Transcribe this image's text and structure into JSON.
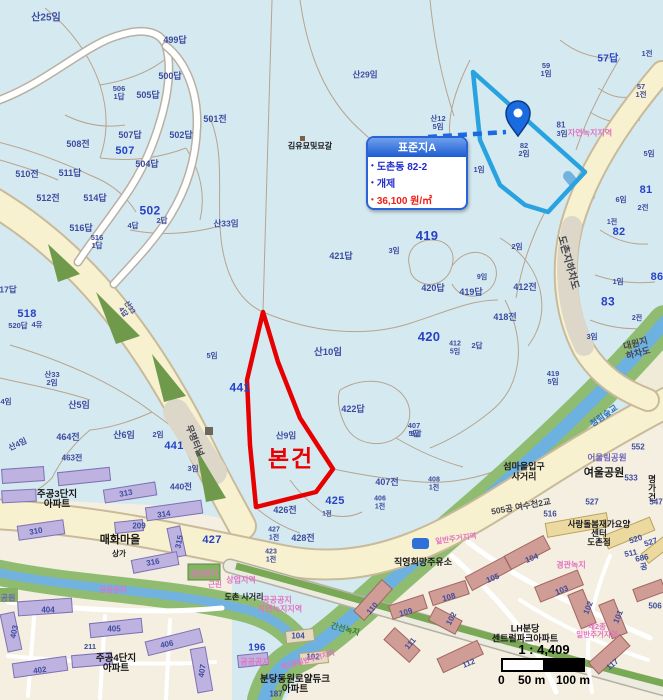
{
  "info_box": {
    "title": "표준지A",
    "rows": [
      {
        "text": "도촌동 82-2",
        "color": "blue"
      },
      {
        "text": "개제",
        "color": "blue"
      },
      {
        "text": "36,100 원/㎡",
        "color": "red"
      }
    ],
    "accent_color": "#2a62d8",
    "value_color": "#f11e12"
  },
  "scale_bar": {
    "ratio": "1 : 4,409",
    "start": "0",
    "mid": "50 m",
    "end": "100 m"
  },
  "map": {
    "overlays": {
      "subject_parcel": {
        "label": "본건",
        "color": "#e60000",
        "points": [
          [
            263,
            312
          ],
          [
            278,
            362
          ],
          [
            300,
            418
          ],
          [
            333,
            469
          ],
          [
            316,
            492
          ],
          [
            256,
            507
          ],
          [
            250,
            445
          ],
          [
            247,
            380
          ]
        ]
      },
      "standard_parcel": {
        "label": "표준지A",
        "color": "#29a3e0",
        "points": [
          [
            473,
            72
          ],
          [
            480,
            140
          ],
          [
            500,
            185
          ],
          [
            525,
            205
          ],
          [
            548,
            212
          ],
          [
            585,
            172
          ]
        ]
      },
      "leader_line": {
        "from": [
          428,
          137
        ],
        "to": [
          506,
          132
        ],
        "color": "#1a6be0"
      },
      "pin": {
        "x": 518,
        "y": 136,
        "color": "#1a6be0"
      }
    },
    "labels": [
      {
        "t": "산25임",
        "x": 46,
        "y": 19,
        "s": 10
      },
      {
        "t": "499답",
        "x": 175,
        "y": 41
      },
      {
        "t": "500답",
        "x": 170,
        "y": 77
      },
      {
        "t": "505답",
        "x": 148,
        "y": 96
      },
      {
        "t": "506\n1답",
        "x": 119,
        "y": 93,
        "s": 7.5
      },
      {
        "t": "501전",
        "x": 215,
        "y": 120
      },
      {
        "t": "508전",
        "x": 78,
        "y": 145
      },
      {
        "t": "507답",
        "x": 130,
        "y": 136
      },
      {
        "t": "507",
        "x": 125,
        "y": 152,
        "c": "n",
        "s": 11
      },
      {
        "t": "504답",
        "x": 147,
        "y": 165
      },
      {
        "t": "502답",
        "x": 181,
        "y": 136
      },
      {
        "t": "산29임",
        "x": 365,
        "y": 75,
        "s": 8.5
      },
      {
        "t": "김유묘및묘갈",
        "x": 310,
        "y": 147,
        "c": "k",
        "s": 8
      },
      {
        "t": "산12\n5임",
        "x": 438,
        "y": 123,
        "s": 7.5
      },
      {
        "t": "57답",
        "x": 608,
        "y": 60,
        "c": "n",
        "s": 10
      },
      {
        "t": "59\n1임",
        "x": 546,
        "y": 70,
        "s": 7.5
      },
      {
        "t": "1전",
        "x": 647,
        "y": 54,
        "s": 7.5
      },
      {
        "t": "57\n1전",
        "x": 641,
        "y": 91,
        "s": 7.5
      },
      {
        "t": "82\n2임",
        "x": 524,
        "y": 150,
        "s": 7.5
      },
      {
        "t": "1임",
        "x": 479,
        "y": 170,
        "s": 7.5
      },
      {
        "t": "81",
        "x": 561,
        "y": 126,
        "s": 8
      },
      {
        "t": "3임",
        "x": 562,
        "y": 134,
        "s": 7.5
      },
      {
        "t": "자연녹지지역",
        "x": 590,
        "y": 134,
        "c": "z",
        "s": 8
      },
      {
        "t": "5임",
        "x": 649,
        "y": 154,
        "s": 7.5
      },
      {
        "t": "419",
        "x": 427,
        "y": 236,
        "c": "n",
        "s": 13
      },
      {
        "t": "3임",
        "x": 394,
        "y": 251,
        "s": 7.5
      },
      {
        "t": "421답",
        "x": 341,
        "y": 257
      },
      {
        "t": "2임",
        "x": 517,
        "y": 247,
        "s": 7.5
      },
      {
        "t": "420답",
        "x": 433,
        "y": 289
      },
      {
        "t": "419답",
        "x": 471,
        "y": 293
      },
      {
        "t": "9임",
        "x": 482,
        "y": 278,
        "s": 7
      },
      {
        "t": "412전",
        "x": 525,
        "y": 288
      },
      {
        "t": "418전",
        "x": 505,
        "y": 318
      },
      {
        "t": "420",
        "x": 429,
        "y": 337,
        "c": "n",
        "s": 13
      },
      {
        "t": "412\n5임",
        "x": 455,
        "y": 348,
        "s": 7
      },
      {
        "t": "2답",
        "x": 477,
        "y": 346,
        "s": 7.5
      },
      {
        "t": "도촌지하차도",
        "x": 567,
        "y": 263,
        "c": "r",
        "s": 10,
        "r": 75
      },
      {
        "t": "81",
        "x": 646,
        "y": 191,
        "c": "n",
        "s": 11
      },
      {
        "t": "6임",
        "x": 621,
        "y": 200,
        "s": 7.5
      },
      {
        "t": "2전",
        "x": 643,
        "y": 208,
        "s": 7.5
      },
      {
        "t": "1전",
        "x": 612,
        "y": 223,
        "s": 7
      },
      {
        "t": "82",
        "x": 619,
        "y": 233,
        "c": "n",
        "s": 11
      },
      {
        "t": "86",
        "x": 657,
        "y": 278,
        "c": "n",
        "s": 11
      },
      {
        "t": "1임",
        "x": 618,
        "y": 282,
        "s": 7.5
      },
      {
        "t": "83",
        "x": 608,
        "y": 302,
        "c": "n",
        "s": 12
      },
      {
        "t": "2전",
        "x": 637,
        "y": 319,
        "s": 7
      },
      {
        "t": "3임",
        "x": 592,
        "y": 337,
        "s": 7.5
      },
      {
        "t": "대원지하차도",
        "x": 637,
        "y": 349,
        "c": "r",
        "s": 9,
        "r": -15
      },
      {
        "t": "419\n5임",
        "x": 553,
        "y": 378,
        "s": 7.5
      },
      {
        "t": "산33임",
        "x": 226,
        "y": 224,
        "s": 8.5
      },
      {
        "t": "510전",
        "x": 27,
        "y": 175
      },
      {
        "t": "511답",
        "x": 70,
        "y": 174
      },
      {
        "t": "512전",
        "x": 48,
        "y": 199
      },
      {
        "t": "514답",
        "x": 95,
        "y": 199
      },
      {
        "t": "516답",
        "x": 81,
        "y": 229
      },
      {
        "t": "516\n1답",
        "x": 97,
        "y": 242,
        "s": 7.5
      },
      {
        "t": "502",
        "x": 150,
        "y": 211,
        "c": "n",
        "s": 12
      },
      {
        "t": "4답",
        "x": 133,
        "y": 226,
        "s": 7.5
      },
      {
        "t": "2답",
        "x": 162,
        "y": 221,
        "s": 7.5
      },
      {
        "t": "17답",
        "x": 8,
        "y": 290,
        "s": 8.5
      },
      {
        "t": "518",
        "x": 27,
        "y": 315,
        "c": "n",
        "s": 11
      },
      {
        "t": "520답",
        "x": 18,
        "y": 326,
        "s": 7.5
      },
      {
        "t": "4유",
        "x": 37,
        "y": 325,
        "s": 7.5
      },
      {
        "t": "산33\n4답",
        "x": 126,
        "y": 310,
        "s": 7,
        "r": 55
      },
      {
        "t": "441",
        "x": 240,
        "y": 388,
        "c": "n",
        "s": 12
      },
      {
        "t": "산10임",
        "x": 328,
        "y": 353,
        "s": 9.5
      },
      {
        "t": "산9임",
        "x": 286,
        "y": 436,
        "s": 8.5
      },
      {
        "t": "본건",
        "x": 291,
        "y": 459,
        "c": "red",
        "s": 23
      },
      {
        "t": "422답",
        "x": 353,
        "y": 410
      },
      {
        "t": "407\n5답",
        "x": 414,
        "y": 430,
        "s": 7.5
      },
      {
        "t": "산33\n2임",
        "x": 52,
        "y": 379,
        "s": 7.5
      },
      {
        "t": "4임",
        "x": 6,
        "y": 402,
        "s": 7.5
      },
      {
        "t": "산5임",
        "x": 79,
        "y": 406,
        "s": 9
      },
      {
        "t": "464전",
        "x": 68,
        "y": 438
      },
      {
        "t": "산4임",
        "x": 18,
        "y": 445,
        "s": 8,
        "r": -25
      },
      {
        "t": "463전",
        "x": 72,
        "y": 459,
        "s": 8
      },
      {
        "t": "산6임",
        "x": 124,
        "y": 436,
        "s": 9
      },
      {
        "t": "2임",
        "x": 158,
        "y": 435,
        "s": 7.5
      },
      {
        "t": "441",
        "x": 174,
        "y": 447,
        "c": "n",
        "s": 11
      },
      {
        "t": "3임",
        "x": 193,
        "y": 469,
        "s": 7.5
      },
      {
        "t": "440전",
        "x": 181,
        "y": 487,
        "s": 8.5
      },
      {
        "t": "5임",
        "x": 212,
        "y": 356,
        "s": 7.5
      },
      {
        "t": "무명터널",
        "x": 194,
        "y": 441,
        "c": "r",
        "s": 9,
        "r": 68
      },
      {
        "t": "407전",
        "x": 387,
        "y": 483
      },
      {
        "t": "406\n1전",
        "x": 380,
        "y": 503,
        "s": 7
      },
      {
        "t": "408\n1전",
        "x": 434,
        "y": 484,
        "s": 7
      },
      {
        "t": "425",
        "x": 335,
        "y": 502,
        "c": "n",
        "s": 11
      },
      {
        "t": "426전",
        "x": 285,
        "y": 511
      },
      {
        "t": "427\n1전",
        "x": 274,
        "y": 534,
        "s": 7
      },
      {
        "t": "428전",
        "x": 303,
        "y": 539
      },
      {
        "t": "1전",
        "x": 327,
        "y": 514,
        "s": 6.5
      },
      {
        "t": "427",
        "x": 212,
        "y": 541,
        "c": "n",
        "s": 11
      },
      {
        "t": "423\n1전",
        "x": 271,
        "y": 556,
        "s": 7
      },
      {
        "t": "공공공지",
        "x": 277,
        "y": 601,
        "c": "z",
        "s": 8
      },
      {
        "t": "자연녹지지역",
        "x": 280,
        "y": 610,
        "c": "z",
        "s": 8
      },
      {
        "t": "도촌 사거리",
        "x": 244,
        "y": 598,
        "c": "k",
        "s": 8
      },
      {
        "t": "상업지역",
        "x": 241,
        "y": 581,
        "c": "z",
        "s": 8
      },
      {
        "t": "매화마을",
        "x": 120,
        "y": 541,
        "c": "k",
        "s": 11
      },
      {
        "t": "310",
        "x": 36,
        "y": 532,
        "s": 8,
        "r": -10
      },
      {
        "t": "315",
        "x": 180,
        "y": 542,
        "s": 8,
        "r": -78
      },
      {
        "t": "316",
        "x": 153,
        "y": 563,
        "s": 8,
        "r": -10
      },
      {
        "t": "209",
        "x": 139,
        "y": 527,
        "s": 8
      },
      {
        "t": "313",
        "x": 126,
        "y": 494,
        "s": 8,
        "r": -10
      },
      {
        "t": "314",
        "x": 164,
        "y": 515,
        "s": 8,
        "r": -8
      },
      {
        "t": "주공3단지\n아파트",
        "x": 57,
        "y": 500,
        "c": "k",
        "s": 9.5
      },
      {
        "t": "404",
        "x": 48,
        "y": 611,
        "s": 8
      },
      {
        "t": "405",
        "x": 114,
        "y": 630,
        "s": 8
      },
      {
        "t": "406",
        "x": 167,
        "y": 645,
        "s": 8,
        "r": -12
      },
      {
        "t": "402",
        "x": 40,
        "y": 671,
        "s": 8,
        "r": -8
      },
      {
        "t": "403",
        "x": 15,
        "y": 632,
        "s": 8,
        "r": -78
      },
      {
        "t": "407",
        "x": 203,
        "y": 671,
        "s": 8,
        "r": -80
      },
      {
        "t": "주공4단지\n아파트",
        "x": 116,
        "y": 664,
        "c": "k",
        "s": 9.5
      },
      {
        "t": "211",
        "x": 90,
        "y": 647,
        "s": 7.5
      },
      {
        "t": "196",
        "x": 257,
        "y": 649,
        "c": "n",
        "s": 10
      },
      {
        "t": "공공공지",
        "x": 255,
        "y": 663,
        "c": "z",
        "s": 8
      },
      {
        "t": "104",
        "x": 298,
        "y": 637,
        "s": 8
      },
      {
        "t": "102",
        "x": 313,
        "y": 658,
        "s": 8
      },
      {
        "t": "분당동원로얄듀크\n아파트",
        "x": 295,
        "y": 685,
        "c": "k",
        "s": 9.5
      },
      {
        "t": "187",
        "x": 276,
        "y": 695,
        "s": 8
      },
      {
        "t": "제3종일반주거지역",
        "x": 308,
        "y": 661,
        "c": "z",
        "s": 7,
        "r": -15
      },
      {
        "t": "110",
        "x": 373,
        "y": 609,
        "s": 8,
        "r": -50
      },
      {
        "t": "109",
        "x": 406,
        "y": 613,
        "s": 8,
        "r": -15
      },
      {
        "t": "108",
        "x": 449,
        "y": 598,
        "s": 8,
        "r": -15
      },
      {
        "t": "111",
        "x": 411,
        "y": 644,
        "s": 8,
        "r": -50
      },
      {
        "t": "102",
        "x": 452,
        "y": 619,
        "s": 8,
        "r": -62
      },
      {
        "t": "직영희망주유소",
        "x": 423,
        "y": 563,
        "c": "k",
        "s": 9
      },
      {
        "t": "일반주거지역",
        "x": 456,
        "y": 539,
        "c": "z",
        "s": 7.5,
        "r": -8
      },
      {
        "t": "섬마을입구\n사거리",
        "x": 524,
        "y": 472,
        "c": "k",
        "s": 9
      },
      {
        "t": "505공 여수천2교",
        "x": 521,
        "y": 507,
        "c": "r",
        "s": 8.5,
        "r": -10
      },
      {
        "t": "사랑돌봄재가요양센터\n도촌점",
        "x": 599,
        "y": 534,
        "c": "k",
        "s": 8.5
      },
      {
        "t": "경관녹지",
        "x": 571,
        "y": 566,
        "c": "z",
        "s": 8
      },
      {
        "t": "104",
        "x": 532,
        "y": 559,
        "s": 8,
        "r": -22
      },
      {
        "t": "105",
        "x": 493,
        "y": 579,
        "s": 8,
        "r": -22
      },
      {
        "t": "103",
        "x": 562,
        "y": 591,
        "s": 8,
        "r": -22
      },
      {
        "t": "102",
        "x": 589,
        "y": 608,
        "s": 8,
        "r": -68
      },
      {
        "t": "101",
        "x": 619,
        "y": 617,
        "s": 8,
        "r": -68
      },
      {
        "t": "112",
        "x": 469,
        "y": 664,
        "s": 8,
        "r": -22
      },
      {
        "t": "117",
        "x": 613,
        "y": 665,
        "s": 8,
        "r": -40
      },
      {
        "t": "520",
        "x": 636,
        "y": 540,
        "s": 8,
        "r": -18
      },
      {
        "t": "527",
        "x": 651,
        "y": 543,
        "s": 8,
        "r": -18
      },
      {
        "t": "511",
        "x": 631,
        "y": 554,
        "s": 8,
        "r": -12
      },
      {
        "t": "686공",
        "x": 643,
        "y": 563,
        "s": 8,
        "r": -12
      },
      {
        "t": "506",
        "x": 655,
        "y": 607,
        "s": 8
      },
      {
        "t": "LH분당\n센트럴파크아파트",
        "x": 525,
        "y": 634,
        "c": "k",
        "s": 9
      },
      {
        "t": "제2종\n일반주거지역",
        "x": 597,
        "y": 631,
        "c": "z",
        "s": 7.5
      },
      {
        "t": "여울공원",
        "x": 604,
        "y": 474,
        "c": "k",
        "s": 11
      },
      {
        "t": "어울림공원",
        "x": 607,
        "y": 458,
        "c": "pk",
        "s": 8.5
      },
      {
        "t": "552",
        "x": 638,
        "y": 448,
        "s": 8
      },
      {
        "t": "533",
        "x": 631,
        "y": 479,
        "s": 8
      },
      {
        "t": "명가건",
        "x": 652,
        "y": 489,
        "c": "k",
        "s": 8.5
      },
      {
        "t": "547",
        "x": 656,
        "y": 503,
        "s": 8
      },
      {
        "t": "516",
        "x": 550,
        "y": 515,
        "s": 8
      },
      {
        "t": "527",
        "x": 592,
        "y": 503,
        "s": 8
      },
      {
        "t": "청림숲교",
        "x": 604,
        "y": 416,
        "c": "w",
        "s": 8.5,
        "r": -35
      },
      {
        "t": "5답",
        "x": 416,
        "y": 434,
        "s": 7.5
      },
      {
        "t": "공공용지",
        "x": 204,
        "y": 574,
        "c": "z",
        "s": 7.5
      },
      {
        "t": "공공용지",
        "x": 113,
        "y": 590,
        "c": "z",
        "s": 7.5
      },
      {
        "t": "간선녹지",
        "x": 345,
        "y": 630,
        "c": "g",
        "s": 8,
        "r": 15
      },
      {
        "t": "상가",
        "x": 119,
        "y": 554,
        "c": "k",
        "s": 7.5
      },
      {
        "t": "근린",
        "x": 215,
        "y": 585,
        "c": "z",
        "s": 7.5
      },
      {
        "t": "공원",
        "x": 8,
        "y": 599,
        "c": "pk",
        "s": 8
      }
    ]
  }
}
